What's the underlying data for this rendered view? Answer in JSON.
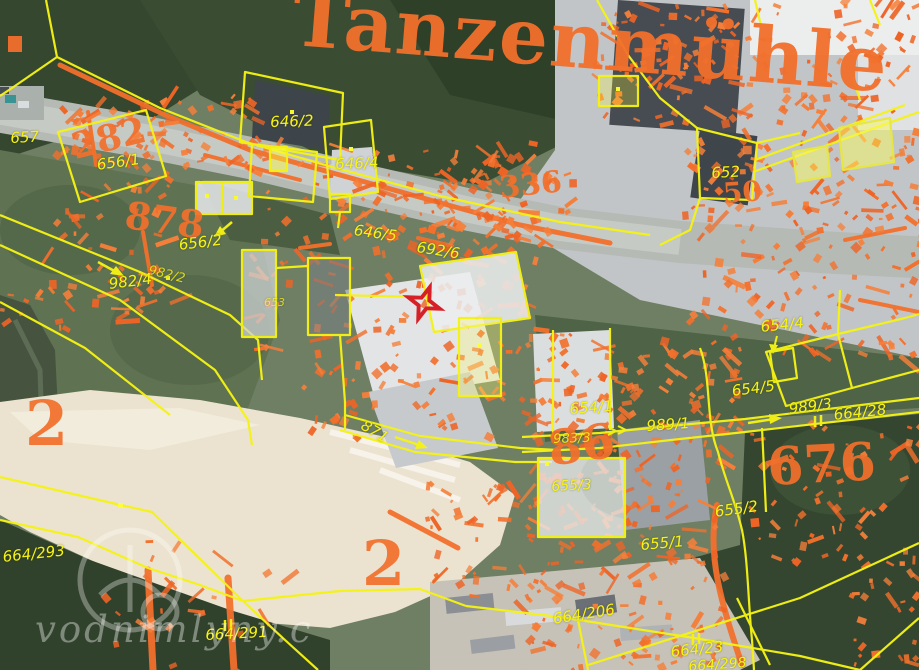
{
  "map": {
    "place_label": {
      "text": "Tanzenmühle"
    },
    "watermark": {
      "text": "vodnimlyny.c",
      "logo": "water-mill-logo"
    },
    "marker": {
      "type": "red-star",
      "x": 424,
      "y": 303,
      "color": "#d61f26"
    },
    "colors": {
      "cadastral_yellow": "#f7f414",
      "old_map_orange": "#f2702c",
      "marker_red": "#d61f26",
      "highlight_fill": "rgba(252,252,90,0.45)"
    },
    "cadastral_labels": [
      {
        "text": "657",
        "x": 10,
        "y": 131,
        "rot": -3,
        "size": 15
      },
      {
        "text": "656/1",
        "x": 96,
        "y": 158,
        "rot": -8,
        "size": 15
      },
      {
        "text": "656/2",
        "x": 178,
        "y": 238,
        "rot": -7,
        "size": 15
      },
      {
        "text": "982/2",
        "x": 150,
        "y": 264,
        "rot": 14,
        "size": 13,
        "opacity": 0.8
      },
      {
        "text": "982/4",
        "x": 108,
        "y": 277,
        "rot": -7,
        "size": 15
      },
      {
        "text": "646/2",
        "x": 270,
        "y": 115,
        "rot": -2,
        "size": 15
      },
      {
        "text": "646/4",
        "x": 335,
        "y": 157,
        "rot": -2,
        "size": 15
      },
      {
        "text": "646/5",
        "x": 355,
        "y": 223,
        "rot": 8,
        "size": 15
      },
      {
        "text": "692/6",
        "x": 418,
        "y": 240,
        "rot": 9,
        "size": 15
      },
      {
        "text": "653",
        "x": 264,
        "y": 297,
        "rot": 0,
        "size": 11,
        "opacity": 0.75
      },
      {
        "text": "652",
        "x": 711,
        "y": 166,
        "rot": -3,
        "size": 15
      },
      {
        "text": "654/4",
        "x": 760,
        "y": 320,
        "rot": -6,
        "size": 15
      },
      {
        "text": "654/5",
        "x": 731,
        "y": 384,
        "rot": -7,
        "size": 15
      },
      {
        "text": "654/1",
        "x": 569,
        "y": 402,
        "rot": -4,
        "size": 15
      },
      {
        "text": "989/1",
        "x": 646,
        "y": 419,
        "rot": -4,
        "size": 15
      },
      {
        "text": "983/3",
        "x": 553,
        "y": 433,
        "rot": -2,
        "size": 13,
        "opacity": 0.85
      },
      {
        "text": "655/3",
        "x": 551,
        "y": 480,
        "rot": -3,
        "size": 14
      },
      {
        "text": "989/3",
        "x": 788,
        "y": 402,
        "rot": -7,
        "size": 15
      },
      {
        "text": "664/28",
        "x": 833,
        "y": 408,
        "rot": -6,
        "size": 15
      },
      {
        "text": "655/2",
        "x": 714,
        "y": 505,
        "rot": -8,
        "size": 15
      },
      {
        "text": "655/1",
        "x": 640,
        "y": 538,
        "rot": -5,
        "size": 15
      },
      {
        "text": "871",
        "x": 366,
        "y": 418,
        "rot": 31,
        "size": 15
      },
      {
        "text": "664/293",
        "x": 2,
        "y": 550,
        "rot": -6,
        "size": 15
      },
      {
        "text": "664/291",
        "x": 205,
        "y": 628,
        "rot": -3,
        "size": 15
      },
      {
        "text": "664/206",
        "x": 552,
        "y": 612,
        "rot": -9,
        "size": 15
      },
      {
        "text": "664/23",
        "x": 670,
        "y": 645,
        "rot": -6,
        "size": 15
      },
      {
        "text": "664/298",
        "x": 688,
        "y": 660,
        "rot": -4,
        "size": 14
      }
    ],
    "old_map_labels": [
      {
        "text": "2",
        "x": 25,
        "y": 393,
        "rot": 0,
        "size": 62
      },
      {
        "text": "2",
        "x": 362,
        "y": 533,
        "rot": 0,
        "size": 62
      },
      {
        "text": "282",
        "x": 68,
        "y": 130,
        "rot": -14,
        "size": 36
      },
      {
        "text": "878",
        "x": 128,
        "y": 196,
        "rot": 8,
        "size": 38
      },
      {
        "text": "336",
        "x": 498,
        "y": 174,
        "rot": -6,
        "size": 30
      },
      {
        "text": "50",
        "x": 722,
        "y": 180,
        "rot": -4,
        "size": 28
      },
      {
        "text": "86",
        "x": 545,
        "y": 426,
        "rot": -8,
        "size": 48
      },
      {
        "text": "676",
        "x": 766,
        "y": 442,
        "rot": -3,
        "size": 52
      }
    ]
  }
}
